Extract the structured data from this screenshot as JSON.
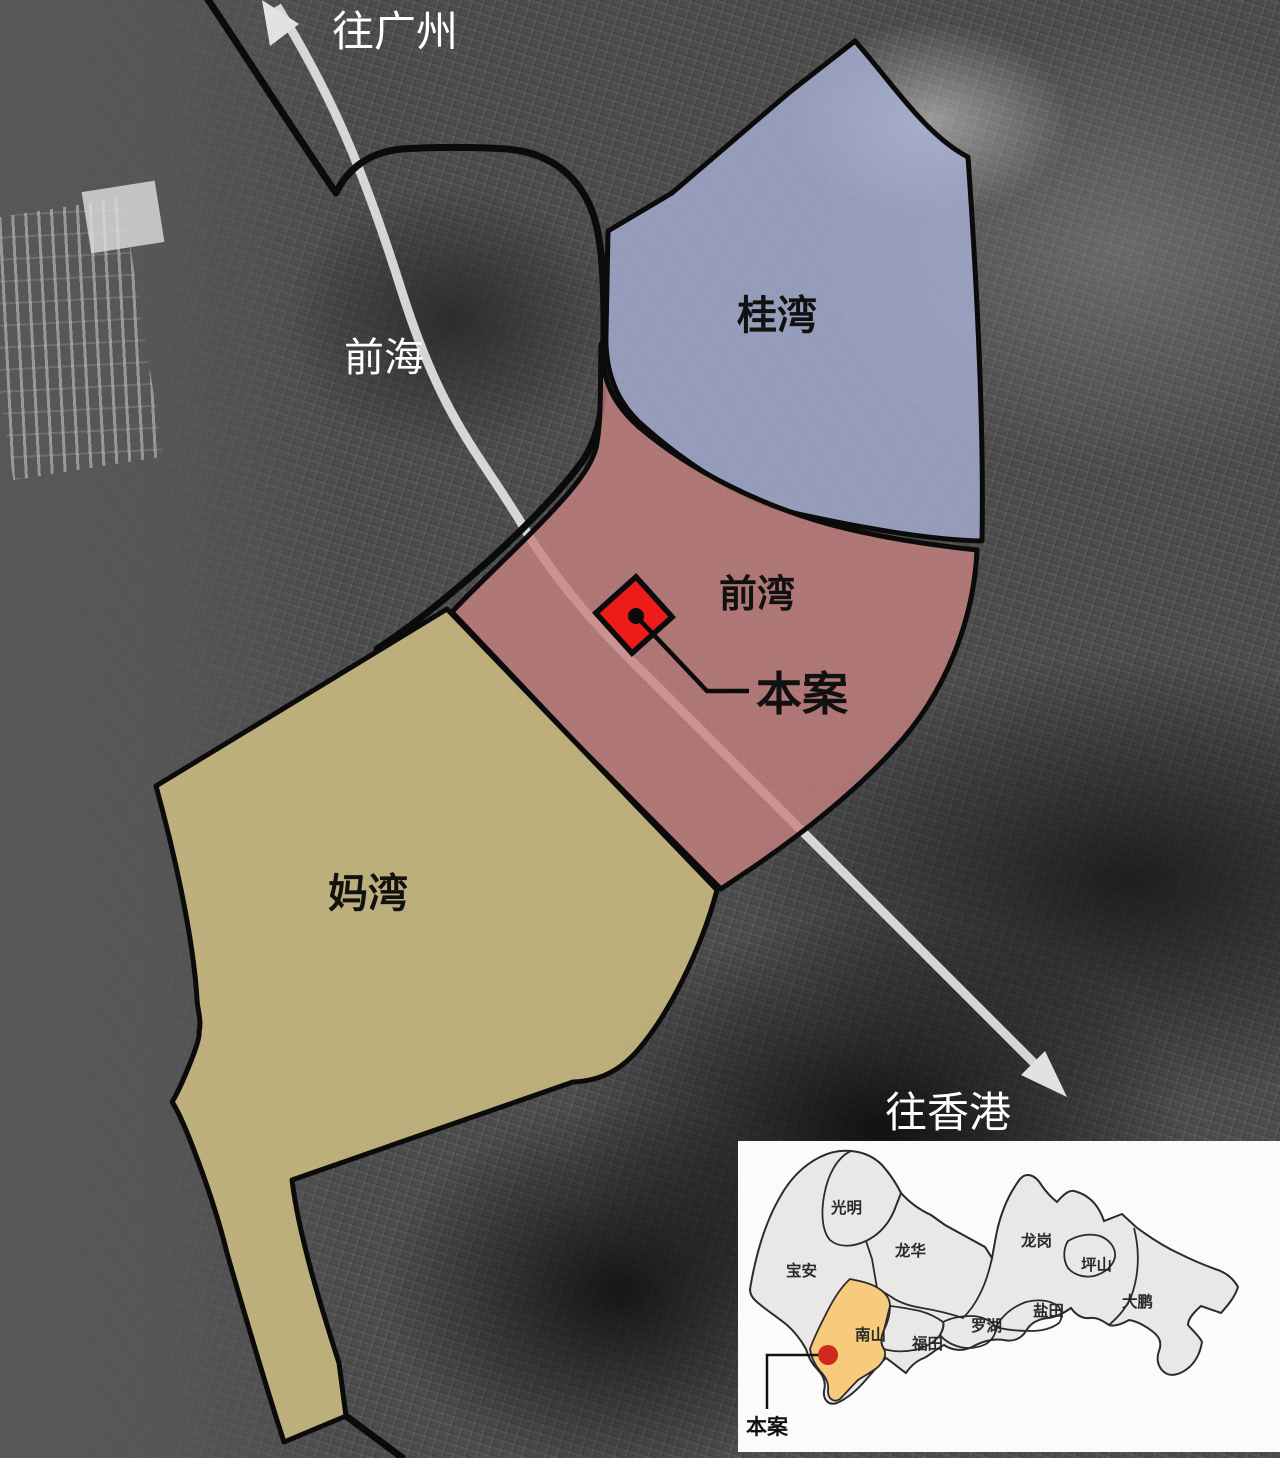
{
  "map": {
    "direction_labels": {
      "north": "往广州",
      "south": "往香港"
    },
    "sea_label": "前海",
    "zones": [
      {
        "name": "桂湾",
        "color": "#aab4d9"
      },
      {
        "name": "前湾",
        "color": "#c88181"
      },
      {
        "name": "妈湾",
        "color": "#d5c485"
      }
    ],
    "site": {
      "label": "本案",
      "marker_color": "#ee1b1b"
    }
  },
  "inset": {
    "highlight_district": "南山",
    "highlight_color": "#f6cb7c",
    "marker_color": "#d2281e",
    "site_label": "本案",
    "districts": [
      {
        "name": "光明"
      },
      {
        "name": "宝安"
      },
      {
        "name": "龙华"
      },
      {
        "name": "龙岗"
      },
      {
        "name": "坪山"
      },
      {
        "name": "盐田"
      },
      {
        "name": "罗湖"
      },
      {
        "name": "福田"
      },
      {
        "name": "南山"
      },
      {
        "name": "大鹏"
      }
    ]
  }
}
